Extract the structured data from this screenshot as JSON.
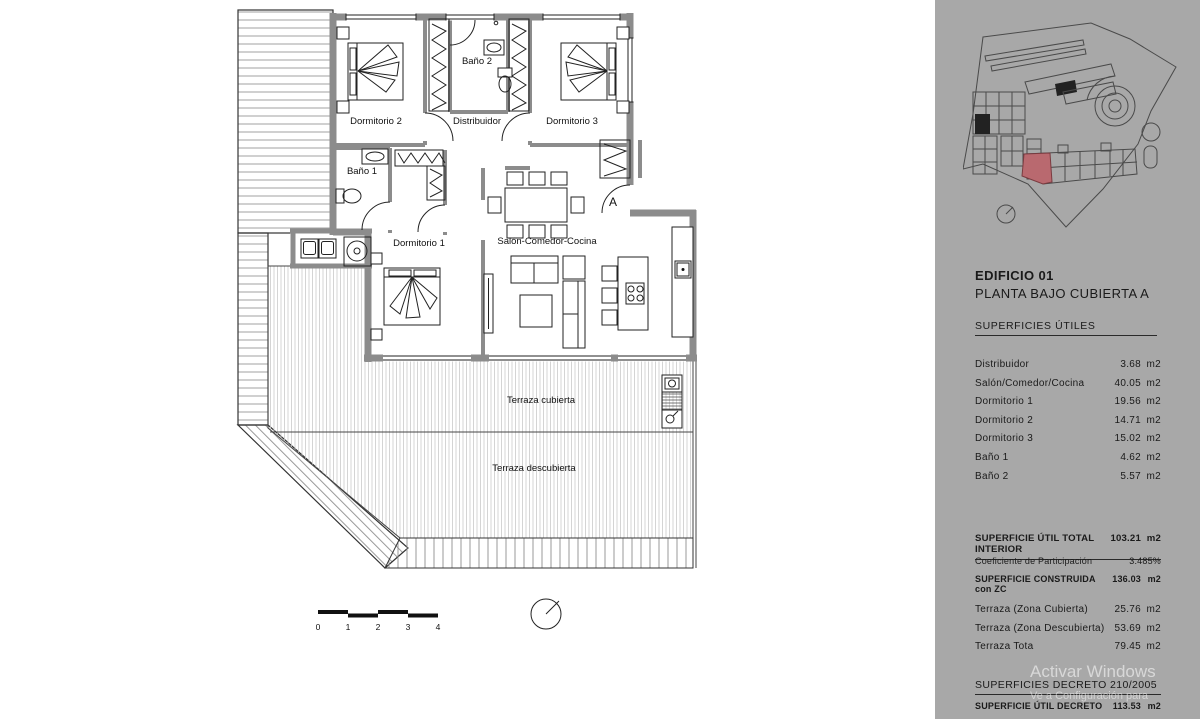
{
  "colors": {
    "panel_bg": "#a8a8a8",
    "plan_bg": "#ffffff",
    "wall_gray": "#8c8c8c",
    "unit_red": "#b9696f",
    "ink": "#1a1a1a"
  },
  "plan": {
    "labels": {
      "dormitorio2": "Dormitorio 2",
      "distribuidor": "Distribuidor",
      "dormitorio3": "Dormitorio 3",
      "bano2": "Baño 2",
      "bano1": "Baño 1",
      "dormitorio1": "Dormitorio 1",
      "salon": "Salón-Comedor-Cocina",
      "terraza_cubierta": "Terraza cubierta",
      "terraza_descubierta": "Terraza descubierta",
      "entrance": "A"
    },
    "scale_ticks": [
      "0",
      "1",
      "2",
      "3",
      "4"
    ]
  },
  "panel": {
    "title": "EDIFICIO 01",
    "subtitle": "PLANTA BAJO CUBIERTA A",
    "surfaces_heading": "SUPERFICIES ÚTILES",
    "surface_rows": [
      {
        "label": "Distribuidor",
        "value": "3.68",
        "unit": "m2"
      },
      {
        "label": "Salón/Comedor/Cocina",
        "value": "40.05",
        "unit": "m2"
      },
      {
        "label": "Dormitorio 1",
        "value": "19.56",
        "unit": "m2"
      },
      {
        "label": "Dormitorio 2",
        "value": "14.71",
        "unit": "m2"
      },
      {
        "label": "Dormitorio 3",
        "value": "15.02",
        "unit": "m2"
      },
      {
        "label": "Baño 1",
        "value": "4.62",
        "unit": "m2"
      },
      {
        "label": "Baño 2",
        "value": "5.57",
        "unit": "m2"
      }
    ],
    "total_interior": {
      "label": "SUPERFICIE ÚTIL TOTAL INTERIOR",
      "value": "103.21",
      "unit": "m2"
    },
    "coeficiente": {
      "label": "Coeficiente de Participación",
      "value": "3.485%"
    },
    "construida": {
      "label": "SUPERFICIE CONSTRUIDA con ZC",
      "value": "136.03",
      "unit": "m2"
    },
    "terraza_rows": [
      {
        "label": "Terraza (Zona Cubierta)",
        "value": "25.76",
        "unit": "m2"
      },
      {
        "label": "Terraza (Zona Descubierta)",
        "value": "53.69",
        "unit": "m2"
      },
      {
        "label": "Terraza Tota",
        "value": "79.45",
        "unit": "m2"
      }
    ],
    "decreto_heading": "SUPERFICIES DECRETO 210/2005",
    "decreto_row": {
      "label": "SUPERFICIE ÚTIL DECRETO",
      "value": "113.53",
      "unit": "m2"
    }
  },
  "watermark": {
    "line1": "Activar Windows",
    "line2": "Ve a Configuración para"
  }
}
